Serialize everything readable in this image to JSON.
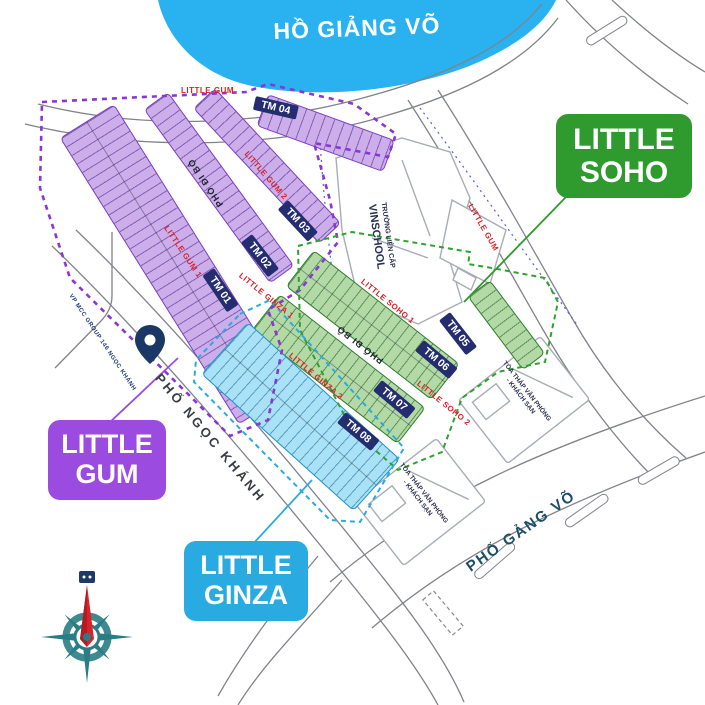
{
  "lake": {
    "label": "HỒ GIẢNG VÕ"
  },
  "callouts": {
    "gum": {
      "line1": "LITTLE",
      "line2": "GUM"
    },
    "soho": {
      "line1": "LITTLE",
      "line2": "SOHO"
    },
    "ginza": {
      "line1": "LITTLE",
      "line2": "GINZA"
    }
  },
  "blocks": {
    "tm01": "TM 01",
    "tm02": "TM 02",
    "tm03": "TM 03",
    "tm04": "TM 04",
    "tm05": "TM 05",
    "tm06": "TM 06",
    "tm07": "TM 07",
    "tm08": "TM 08"
  },
  "streets": {
    "little_gum_top": "LITTLE GUM",
    "little_gum_right": "LITTLE GUM",
    "little_gum_1": "LITTLE GUM 1",
    "little_gum_2": "LITTLE GUM 2",
    "little_soho_1": "LITTLE SOHO 1",
    "little_soho_2": "LITTLE SOHO 2",
    "little_ginza_1": "LITTLE GINZA 1",
    "little_ginza_2": "LITTLE GINZA 2",
    "pho_di_bo_gum": "PHỐ ĐI BỘ",
    "pho_di_bo_soho": "PHỐ ĐI BỘ",
    "pho_ngoc_khanh": "PHỐ NGỌC KHÁNH",
    "pho_giang_vo": "PHỐ GẢNG VÕ"
  },
  "places": {
    "school_line1": "TRƯỜNG LIÊN CẤP",
    "school_line2": "VINSCHOOL",
    "tower_line1": "TÒA THÁP VĂN PHÒNG",
    "tower_line2": "- KHÁCH SẠN",
    "office": "VP MCC GROUP 146 NGỌC KHÁNH"
  },
  "colors": {
    "lake": "#29b2ef",
    "gum": "#9b4be0",
    "soho": "#2f9a2e",
    "ginza": "#29abe2",
    "block_badge": "#232d6f",
    "street_red": "#d8232a"
  }
}
